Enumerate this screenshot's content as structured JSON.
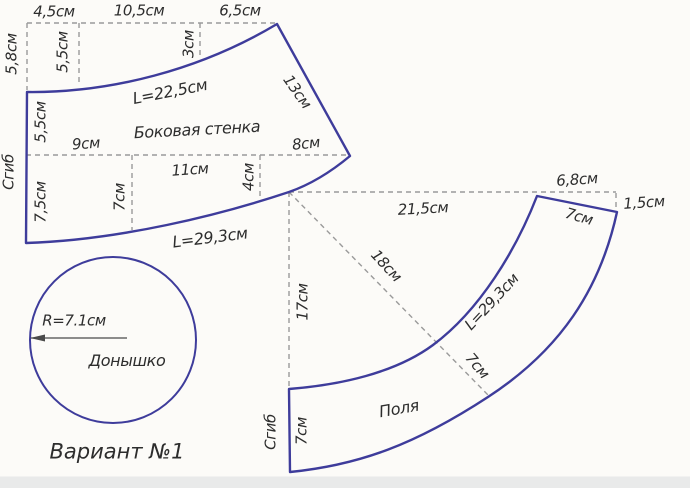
{
  "variant_label": "Вариант №1",
  "colors": {
    "outline_blue": "#3e3c9b",
    "dash_gray": "#9a9a9a",
    "text": "#2d2d2d",
    "background": "#fcfbf8"
  },
  "side_wall": {
    "name": "Боковая стенка",
    "fold_label": "Сгиб",
    "top_arc_length": "L=22,5см",
    "bottom_arc_length": "L=29,3см",
    "top_segments": [
      "4,5см",
      "10,5см",
      "6,5см"
    ],
    "left_offset": "5,8см",
    "curve_drop_left": "5,5см",
    "curve_drop_mid": "3см",
    "left_upper_height": "5,5см",
    "left_lower_height": "7,5см",
    "mid_segments": [
      "9см",
      "11см",
      "8см"
    ],
    "curve_drop_bottom_left": "7см",
    "curve_drop_bottom_right": "4см",
    "right_edge_length": "13см"
  },
  "crown": {
    "name": "Донышко",
    "radius_label": "R=7.1см"
  },
  "brim": {
    "name": "Поля",
    "fold_label": "Сгиб",
    "arc_length": "L=29,3см",
    "top_extent": "21,5см",
    "top_edge": "6,8см",
    "corner_drop": "1,5см",
    "top_right_width": "7см",
    "radius_diagonal": "18см",
    "diagonal_width": "7см",
    "radius_vertical": "17см",
    "fold_edge_width": "7см"
  }
}
